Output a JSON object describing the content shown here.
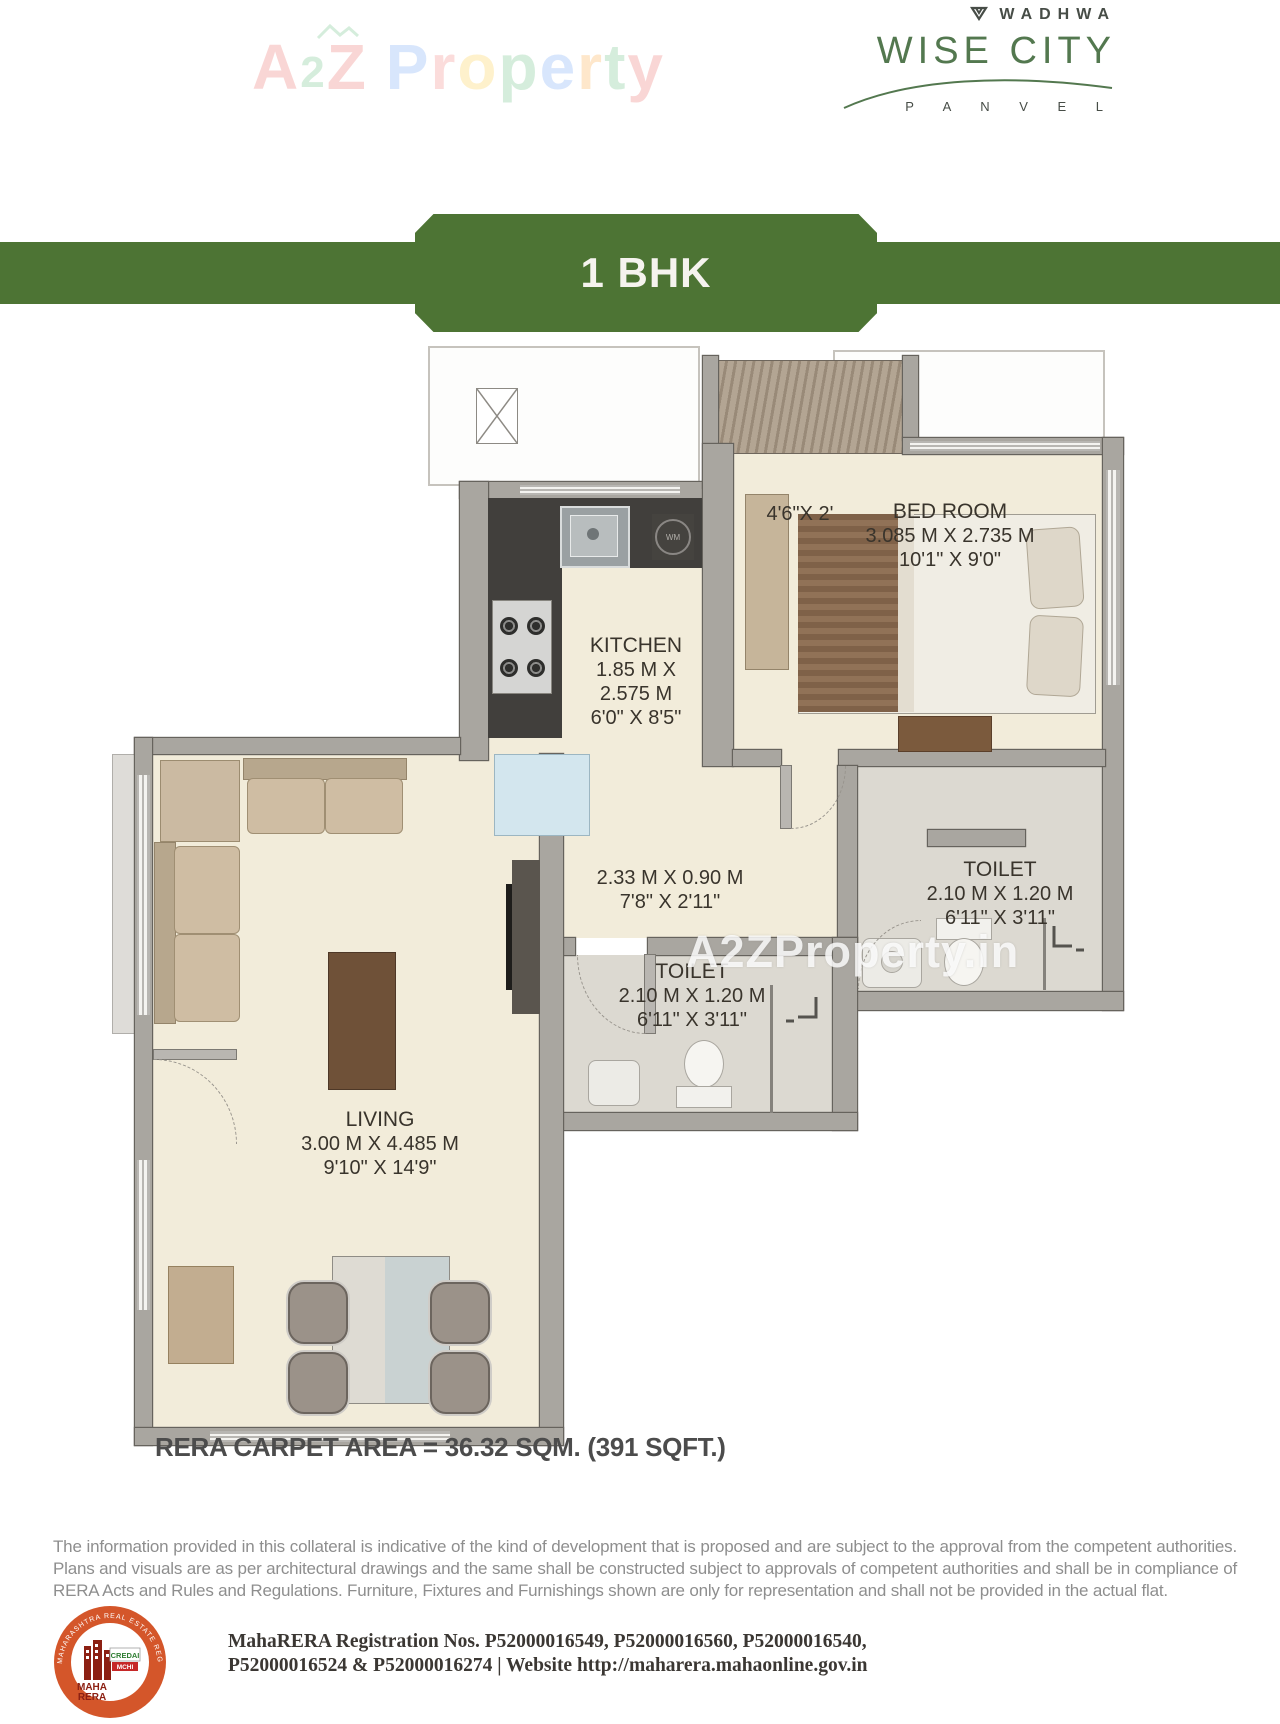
{
  "colors": {
    "banner_green": "#4d7434",
    "logo_green": "#53784f",
    "seal_orange": "#d4562a",
    "floor_beige": "#f2ecda",
    "wall_gray": "#a9a6a0"
  },
  "header": {
    "a2z": {
      "a": "A",
      "two": "2",
      "z": "Z",
      "p1": "P",
      "r1": "r",
      "o1": "o",
      "p2": "p",
      "e1": "e",
      "r2": "r",
      "t1": "t",
      "y1": "y"
    },
    "wadhwa": {
      "brand": "WADHWA",
      "project": "WISE CITY",
      "location": "P A N V E L"
    }
  },
  "banner": {
    "label": "1 BHK"
  },
  "plan": {
    "watermark": "A2ZProperty.in",
    "wm_label": "WM",
    "deck": {
      "dim": "4'6\"X 2'"
    },
    "bedroom": {
      "name": "BED ROOM",
      "metric": "3.085 M X 2.735 M",
      "imperial": "10'1\" X 9'0\""
    },
    "kitchen": {
      "name": "KITCHEN",
      "metric1": "1.85 M X",
      "metric2": "2.575 M",
      "imperial": "6'0\" X 8'5\""
    },
    "passage": {
      "metric": "2.33 M X 0.90 M",
      "imperial": "7'8\" X 2'11\""
    },
    "toilet_attached": {
      "name": "TOILET",
      "metric": "2.10 M X 1.20 M",
      "imperial": "6'11\" X 3'11\""
    },
    "toilet_common": {
      "name": "TOILET",
      "metric": "2.10 M X 1.20 M",
      "imperial": "6'11\" X 3'11\""
    },
    "living": {
      "name": "LIVING",
      "metric": "3.00 M X 4.485 M",
      "imperial": "9'10\" X 14'9\""
    }
  },
  "footer": {
    "carpet_area": "RERA CARPET AREA = 36.32 SQM. (391 SQFT.)",
    "disclaimer": "The information provided in this collateral is indicative of the kind of development that is proposed and are subject to the approval from the competent authorities. Plans and visuals are as per architectural drawings and the same shall be constructed subject to approvals of competent authorities and shall be in compliance of RERA Acts and Rules and Regulations. Furniture, Fixtures and Furnishings shown are only for representation and shall not be provided in the actual flat.",
    "rera": {
      "line1": "MahaRERA Registration Nos. P52000016549, P52000016560, P52000016540,",
      "line2": "P52000016524 & P52000016274 | Website http://maharera.mahaonline.gov.in"
    },
    "seal": {
      "ring": "MAHARASHTRA REAL ESTATE REGULATORY AUTHORITY",
      "hindi": "महा-रेरा",
      "maha": "MAHA",
      "rera": "RERA",
      "credai": "CREDAI",
      "mchi": "MCHI"
    }
  }
}
